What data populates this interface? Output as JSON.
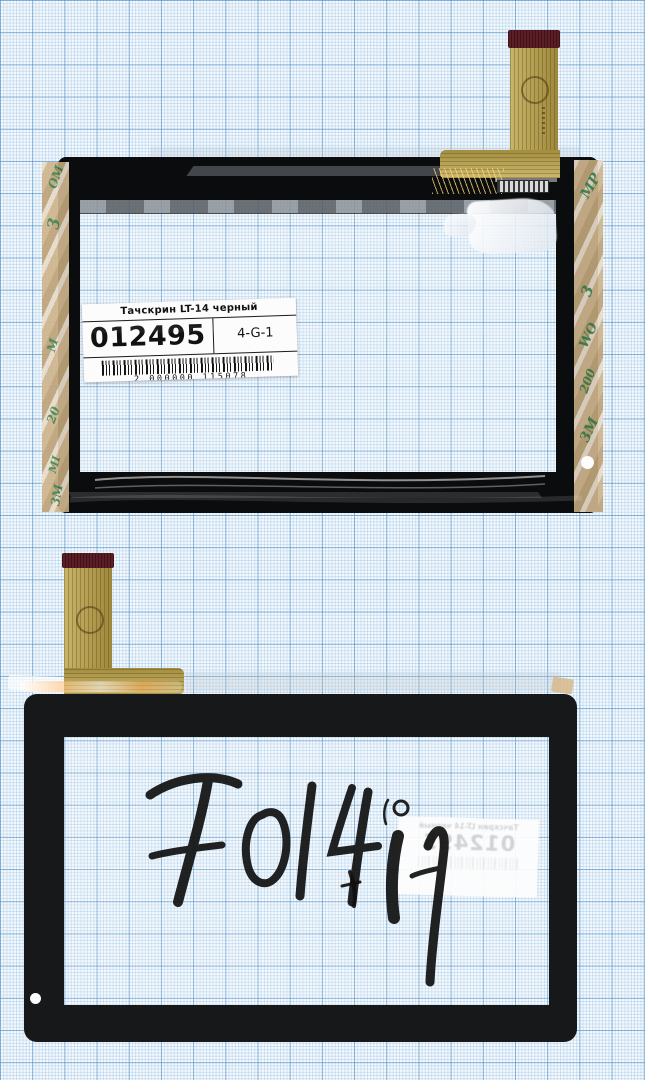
{
  "image_type": "scanned product photo",
  "subject": "Tablet touchscreen digitizer (front and back views) with flex cables on blue graph paper",
  "price_label": {
    "title": "Тачскрин LT-14 черный",
    "code": "012495",
    "cell": "4-G-1",
    "barcode_digits": "2 000000 115078"
  },
  "handwriting": {
    "main": "70140",
    "extra": "ff"
  },
  "tape": {
    "brand": "3M",
    "left_fragments": [
      "OM",
      "3",
      "M",
      "20",
      "MI",
      "3M"
    ],
    "right_fragments": [
      "MP",
      "3",
      "WO",
      "200",
      "3M"
    ]
  },
  "colors": {
    "paper": "#f3f9fd",
    "grid_major": "#4687be",
    "grid_minor": "#78aad7",
    "frame_front": "#0b0c0e",
    "frame_back": "#17181a",
    "flex_gold": "#b29c4b",
    "flex_tip_maroon": "#5c1e24",
    "tape_tan": "#cdb28a",
    "tape_text_green": "#2f7d46"
  }
}
